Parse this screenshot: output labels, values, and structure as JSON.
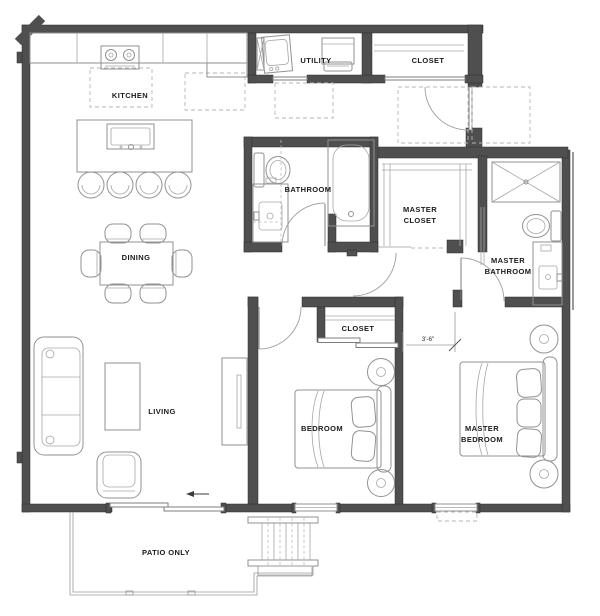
{
  "rooms": {
    "kitchen": "KITCHEN",
    "utility": "UTILITY",
    "entry_closet": "CLOSET",
    "bathroom": "BATHROOM",
    "master_closet": [
      "MASTER",
      "CLOSET"
    ],
    "master_bathroom": [
      "MASTER",
      "BATHROOM"
    ],
    "dining": "DINING",
    "living": "LIVING",
    "bedroom_closet": "CLOSET",
    "bedroom": "BEDROOM",
    "master_bedroom": [
      "MASTER",
      "BEDROOM"
    ],
    "patio": "PATIO ONLY"
  },
  "annotations": {
    "hall_clearance": "3'-6\""
  },
  "colors": {
    "wall": "#4f4f4f",
    "furniture_line": "#929292",
    "dashed_line": "#b5b5b5",
    "label_text": "#1a1a1a",
    "background": "#ffffff"
  }
}
